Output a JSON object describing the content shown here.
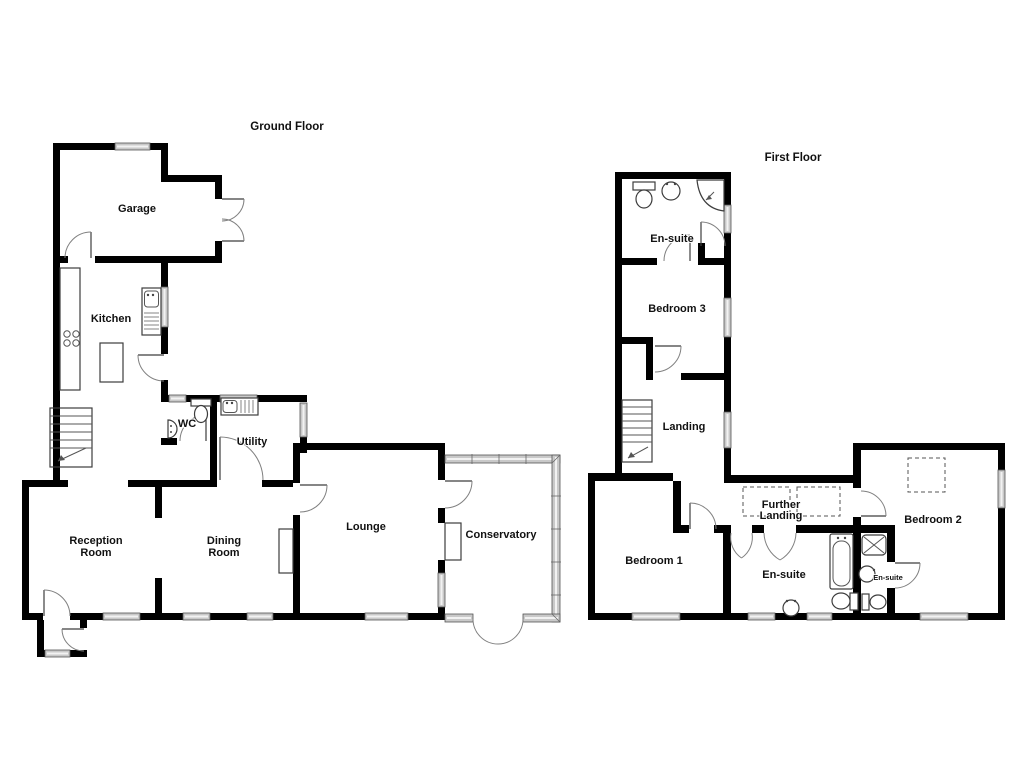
{
  "ground_floor": {
    "title": "Ground Floor",
    "rooms": {
      "garage": "Garage",
      "kitchen": "Kitchen",
      "wc": "WC",
      "utility": "Utility",
      "reception_line1": "Reception",
      "reception_line2": "Room",
      "dining_line1": "Dining",
      "dining_line2": "Room",
      "lounge": "Lounge",
      "conservatory": "Conservatory"
    }
  },
  "first_floor": {
    "title": "First Floor",
    "rooms": {
      "ensuite_top": "En-suite",
      "bedroom3": "Bedroom 3",
      "landing": "Landing",
      "further_landing_line1": "Further",
      "further_landing_line2": "Landing",
      "bedroom1": "Bedroom 1",
      "ensuite_main": "En-suite",
      "ensuite_small": "En-suite",
      "bedroom2": "Bedroom 2"
    }
  },
  "colors": {
    "wall": "#000000",
    "window_fill": "#c9c9c9",
    "line": "#555555"
  }
}
